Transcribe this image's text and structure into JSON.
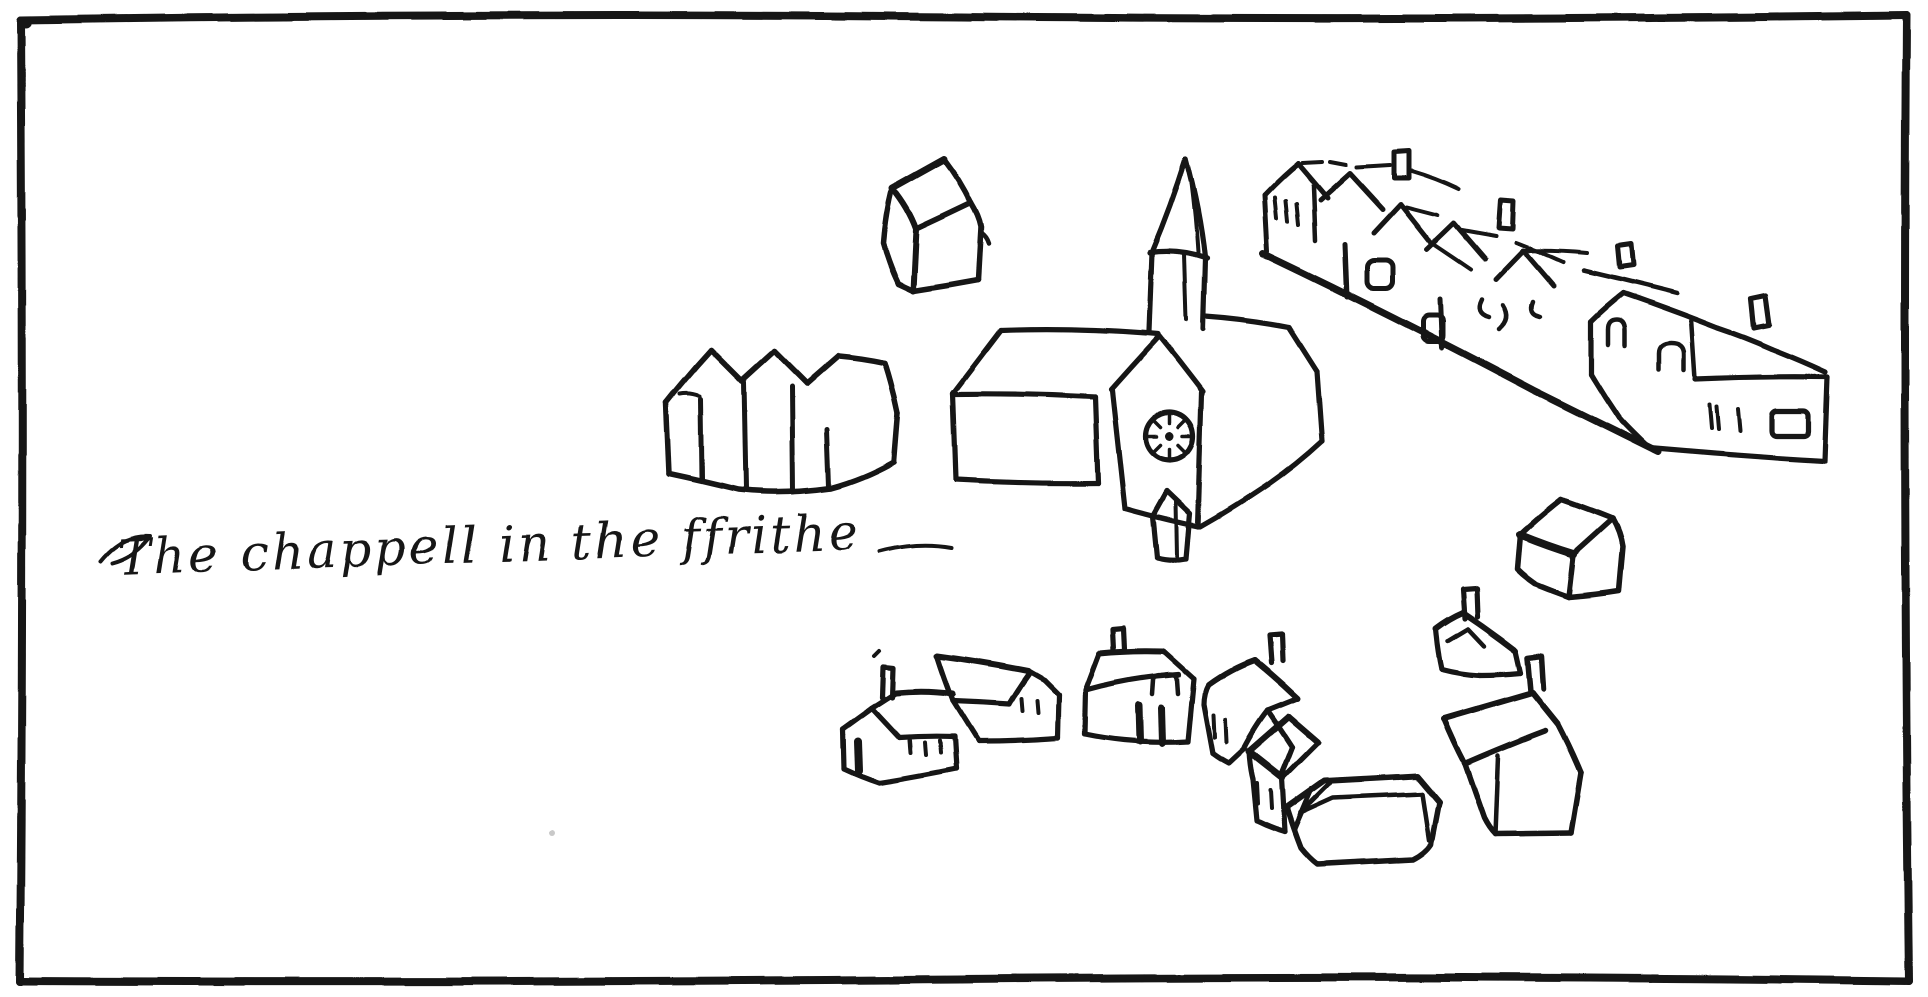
{
  "figure": {
    "caption": "The chappell in the ffrithe",
    "description": "Hand-drawn ink sketch map of a village: church with spire and clock, rows of gabled cottages, scattered houses, rough rectangular frame",
    "ink_color": "#151515",
    "paper_color": "#ffffff"
  },
  "buildings": [
    {
      "id": "church",
      "label": "church with spire, clock face and gabled porch"
    },
    {
      "id": "small-house-north",
      "label": "small cube house north of church"
    },
    {
      "id": "triple-gabled-cottages",
      "label": "row of three gabled cottages"
    },
    {
      "id": "street-row",
      "label": "row of cottages descending along street"
    },
    {
      "id": "street-end-house",
      "label": "large house at end of street row"
    },
    {
      "id": "long-house-west",
      "label": "long house with chimney and doorway"
    },
    {
      "id": "barn-house",
      "label": "gabled barn house"
    },
    {
      "id": "house-with-door",
      "label": "house with arched door and chimney"
    },
    {
      "id": "tilted-house-a",
      "label": "tilted house with chimney"
    },
    {
      "id": "tilted-house-b",
      "label": "small tilted gabled house"
    },
    {
      "id": "box-house",
      "label": "box-roofed house"
    },
    {
      "id": "south-east-house",
      "label": "large tilted house with chimney"
    },
    {
      "id": "small-house-southeast",
      "label": "small house with chimney"
    },
    {
      "id": "small-house-east",
      "label": "small cube house east"
    }
  ]
}
